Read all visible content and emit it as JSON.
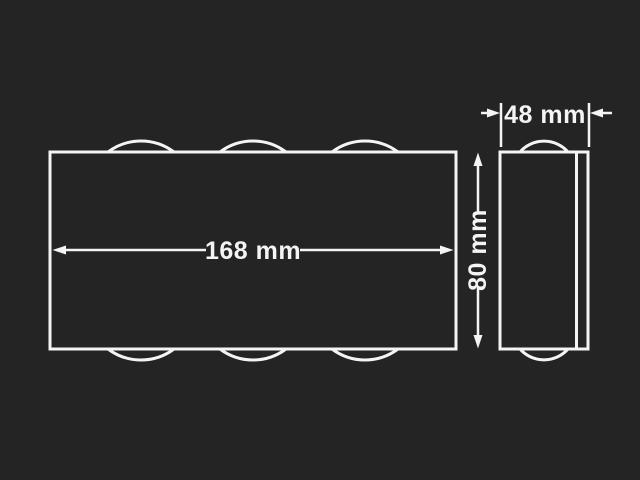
{
  "colors": {
    "background": "#242424",
    "line": "#f4f4f4"
  },
  "diagram": {
    "type": "dimension-drawing",
    "labels": {
      "front_width": "168 mm",
      "side_height": "80 mm",
      "side_depth": "48 mm"
    }
  }
}
